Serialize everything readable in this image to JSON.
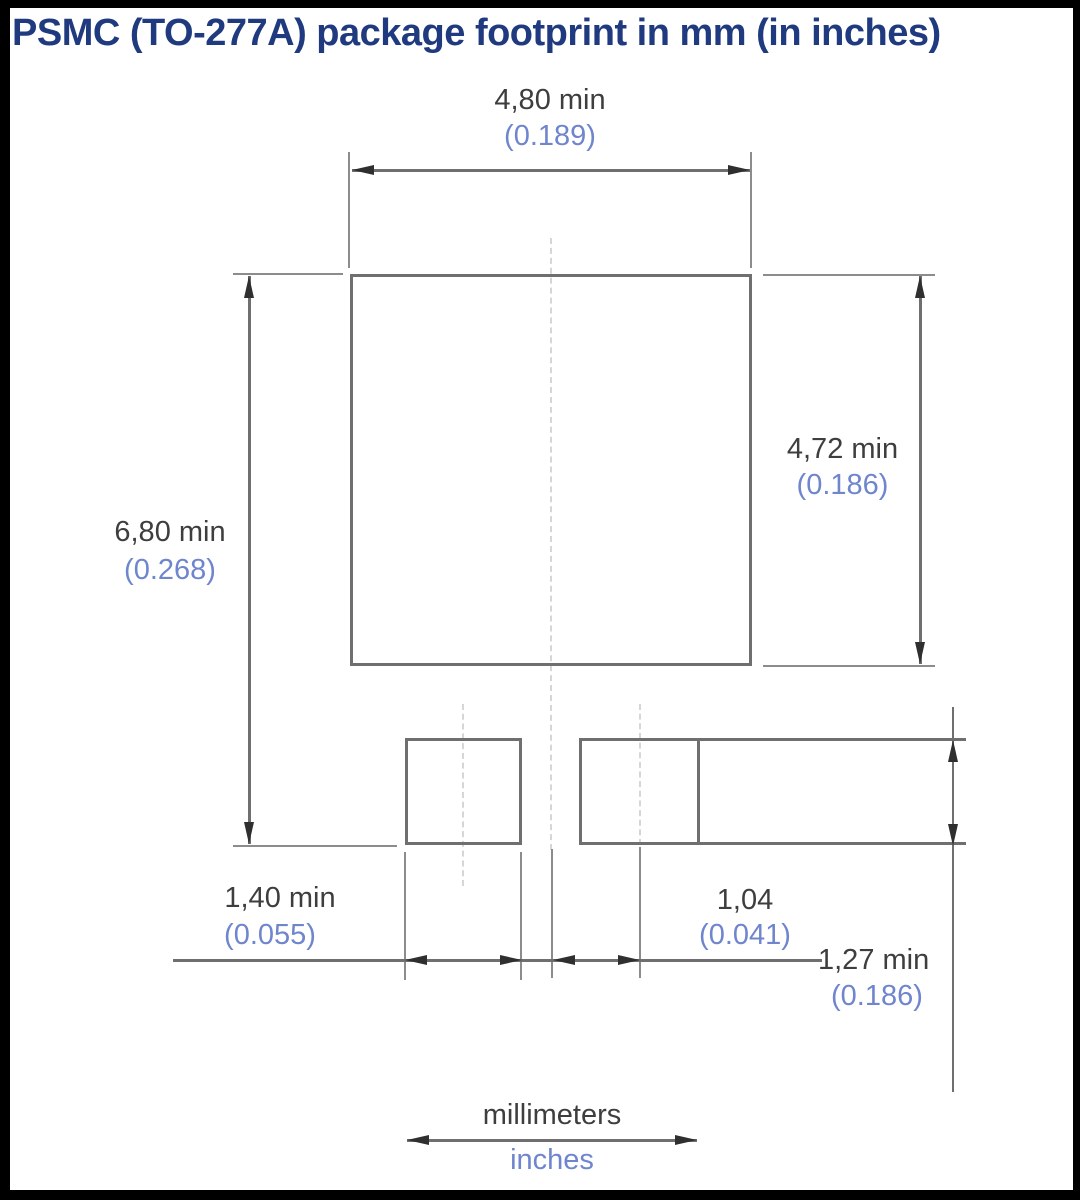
{
  "title": "PSMC (TO-277A) package footprint in mm (in inches)",
  "colors": {
    "title": "#203a80",
    "mm_text": "#3e3e3e",
    "inch_text": "#6f85cd",
    "line": "#6f6f6f",
    "ext_line": "#8c8c8c",
    "arrow": "#2f2f2f",
    "centerline": "#d6d6d6",
    "frame": "#000000",
    "bg": "#ffffff"
  },
  "dimensions": {
    "top_width": {
      "mm": "4,80 min",
      "in": "(0.189)"
    },
    "overall_height": {
      "mm": "6,80 min",
      "in": "(0.268)"
    },
    "main_pad_height": {
      "mm": "4,72 min",
      "in": "(0.186)"
    },
    "lower_pad_width": {
      "mm": "1,40 min",
      "in": "(0.055)"
    },
    "pad_gap": {
      "mm": "1,04",
      "in": "(0.041)"
    },
    "lower_pad_height": {
      "mm": "1,27 min",
      "in": "(0.186)"
    }
  },
  "legend": {
    "mm": "millimeters",
    "in": "inches"
  }
}
